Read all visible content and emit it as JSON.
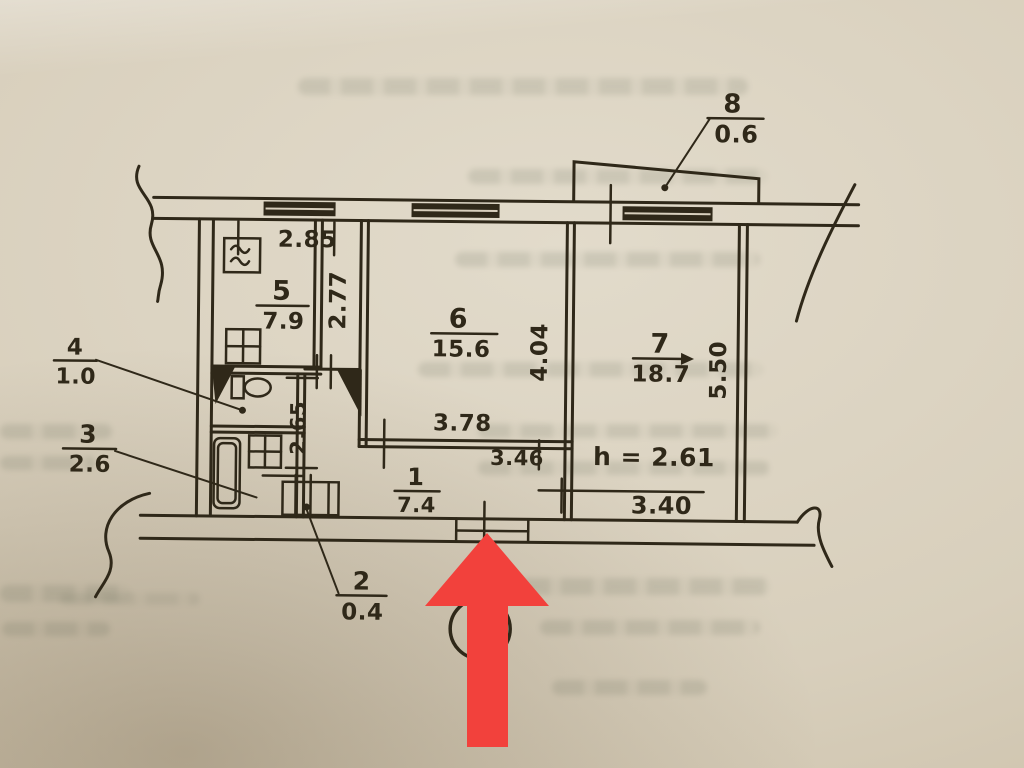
{
  "plan": {
    "rooms": [
      {
        "num": "1",
        "area": "7.4"
      },
      {
        "num": "2",
        "area": "0.4"
      },
      {
        "num": "3",
        "area": "2.6"
      },
      {
        "num": "4",
        "area": "1.0"
      },
      {
        "num": "5",
        "area": "7.9"
      },
      {
        "num": "6",
        "area": "15.6"
      },
      {
        "num": "7",
        "area": "18.7"
      },
      {
        "num": "8",
        "area": "0.6"
      }
    ],
    "dims": {
      "kitchen_width": "2.85",
      "kitchen_depth": "2.77",
      "room6_depth": "4.04",
      "room6_inner_width": "3.78",
      "room6_width": "3.46",
      "room7_depth": "5.50",
      "room7_width": "3.40",
      "bath_depth": "2.65",
      "ceiling_height": "h = 2.61"
    },
    "colors": {
      "ink": "#2f2819",
      "paper": "#d8cfbd",
      "arrow_red": "#f2413c"
    }
  }
}
